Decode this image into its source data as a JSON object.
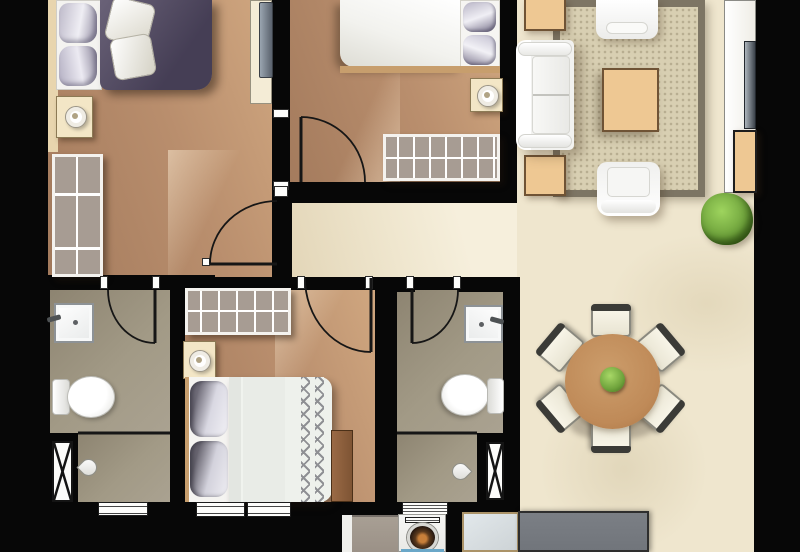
{
  "meta": {
    "type": "apartment-floor-plan",
    "canvas_width": 800,
    "canvas_height": 552,
    "visible_text": "none"
  },
  "palette": {
    "wall": "#070707",
    "floor_bedroom": "#b98e6d",
    "floor_bedroom_dark": "#a47b5d",
    "floor_bedroom_light": "#d0a780",
    "floor_bath": "#a29a86",
    "floor_bath_dark": "#8d8471",
    "floor_hall": "#efe6ce",
    "floor_hall_dark": "#e3d6b8",
    "rug_field": "#d8cfb2",
    "rug_border": "#7d7564",
    "tan_furniture": "#eec893",
    "tan_furniture_border": "#6f5335",
    "nightstand": "#f3e6c6",
    "lamp_dot": "#b0a384",
    "wardrobe_fill": "#a79c93",
    "duvet_purple_a": "#6a6278",
    "duvet_purple_b": "#453e55",
    "pillow_gray": "#8f8aa0",
    "bed_white": "#f2f2ee",
    "bed_frame_tan": "#c79e6d",
    "zigzag": "#8f9094",
    "table_wood": "#bf8a58",
    "chair_seat": "#fbf8ec",
    "chair_back": "#3b3b37",
    "counter_dark": "#71757b",
    "counter_light": "#cdd3d6",
    "slab_taupe": "#9b9187",
    "plant": "#6fa33c",
    "plant_dark": "#3f681d",
    "washer_ember": "#c87f3a",
    "washer_drum": "#241710",
    "accent_blue": "#6aa7c8",
    "door_line": "#161616"
  },
  "rooms": [
    {
      "id": "bedroom-1",
      "name": "master bedroom",
      "floor": "tan wood"
    },
    {
      "id": "bedroom-2",
      "name": "bedroom top-middle",
      "floor": "tan wood"
    },
    {
      "id": "bedroom-3",
      "name": "bedroom bottom-middle",
      "floor": "tan wood"
    },
    {
      "id": "bathroom-1",
      "name": "bathroom left",
      "floor": "olive tile"
    },
    {
      "id": "bathroom-2",
      "name": "bathroom middle",
      "floor": "olive tile"
    },
    {
      "id": "hallway",
      "name": "hallway",
      "floor": "cream tile"
    },
    {
      "id": "living-dining",
      "name": "living and dining area",
      "floor": "beige tile"
    }
  ],
  "furniture": {
    "bedroom_1": [
      "double-bed-purple-duvet",
      "white-pillows",
      "nightstand-with-lamp",
      "shelf-wardrobe",
      "tv-console"
    ],
    "bedroom_2": [
      "double-bed-white-duvet",
      "gray-pillows",
      "nightstand-with-lamp",
      "hanger-wardrobe",
      "swing-door"
    ],
    "bedroom_3": [
      "double-bed-zigzag-duvet",
      "gray-pillows",
      "nightstand-with-lamp",
      "hanger-wardrobe",
      "foot-bench",
      "swing-door",
      "two-windows"
    ],
    "bathroom_1": [
      "sink",
      "toilet",
      "shower-area",
      "shower-head",
      "vent-shaft",
      "swing-door",
      "louver-window"
    ],
    "bathroom_2": [
      "sink",
      "toilet",
      "shower-area",
      "shower-head",
      "vent-shaft",
      "swing-door",
      "louver-window",
      "washing-machine"
    ],
    "living_room": [
      "area-rug",
      "three-seat-sofa",
      "armchair-top",
      "armchair-bottom",
      "coffee-table",
      "side-table-top",
      "side-table-bottom",
      "tv-console",
      "tv",
      "tan-cabinet",
      "potted-plant"
    ],
    "dining": [
      "round-table",
      "six-chairs",
      "center-plant"
    ],
    "kitchen_utility": [
      "dark-counter",
      "glass-counter",
      "taupe-slab",
      "washing-machine"
    ]
  }
}
